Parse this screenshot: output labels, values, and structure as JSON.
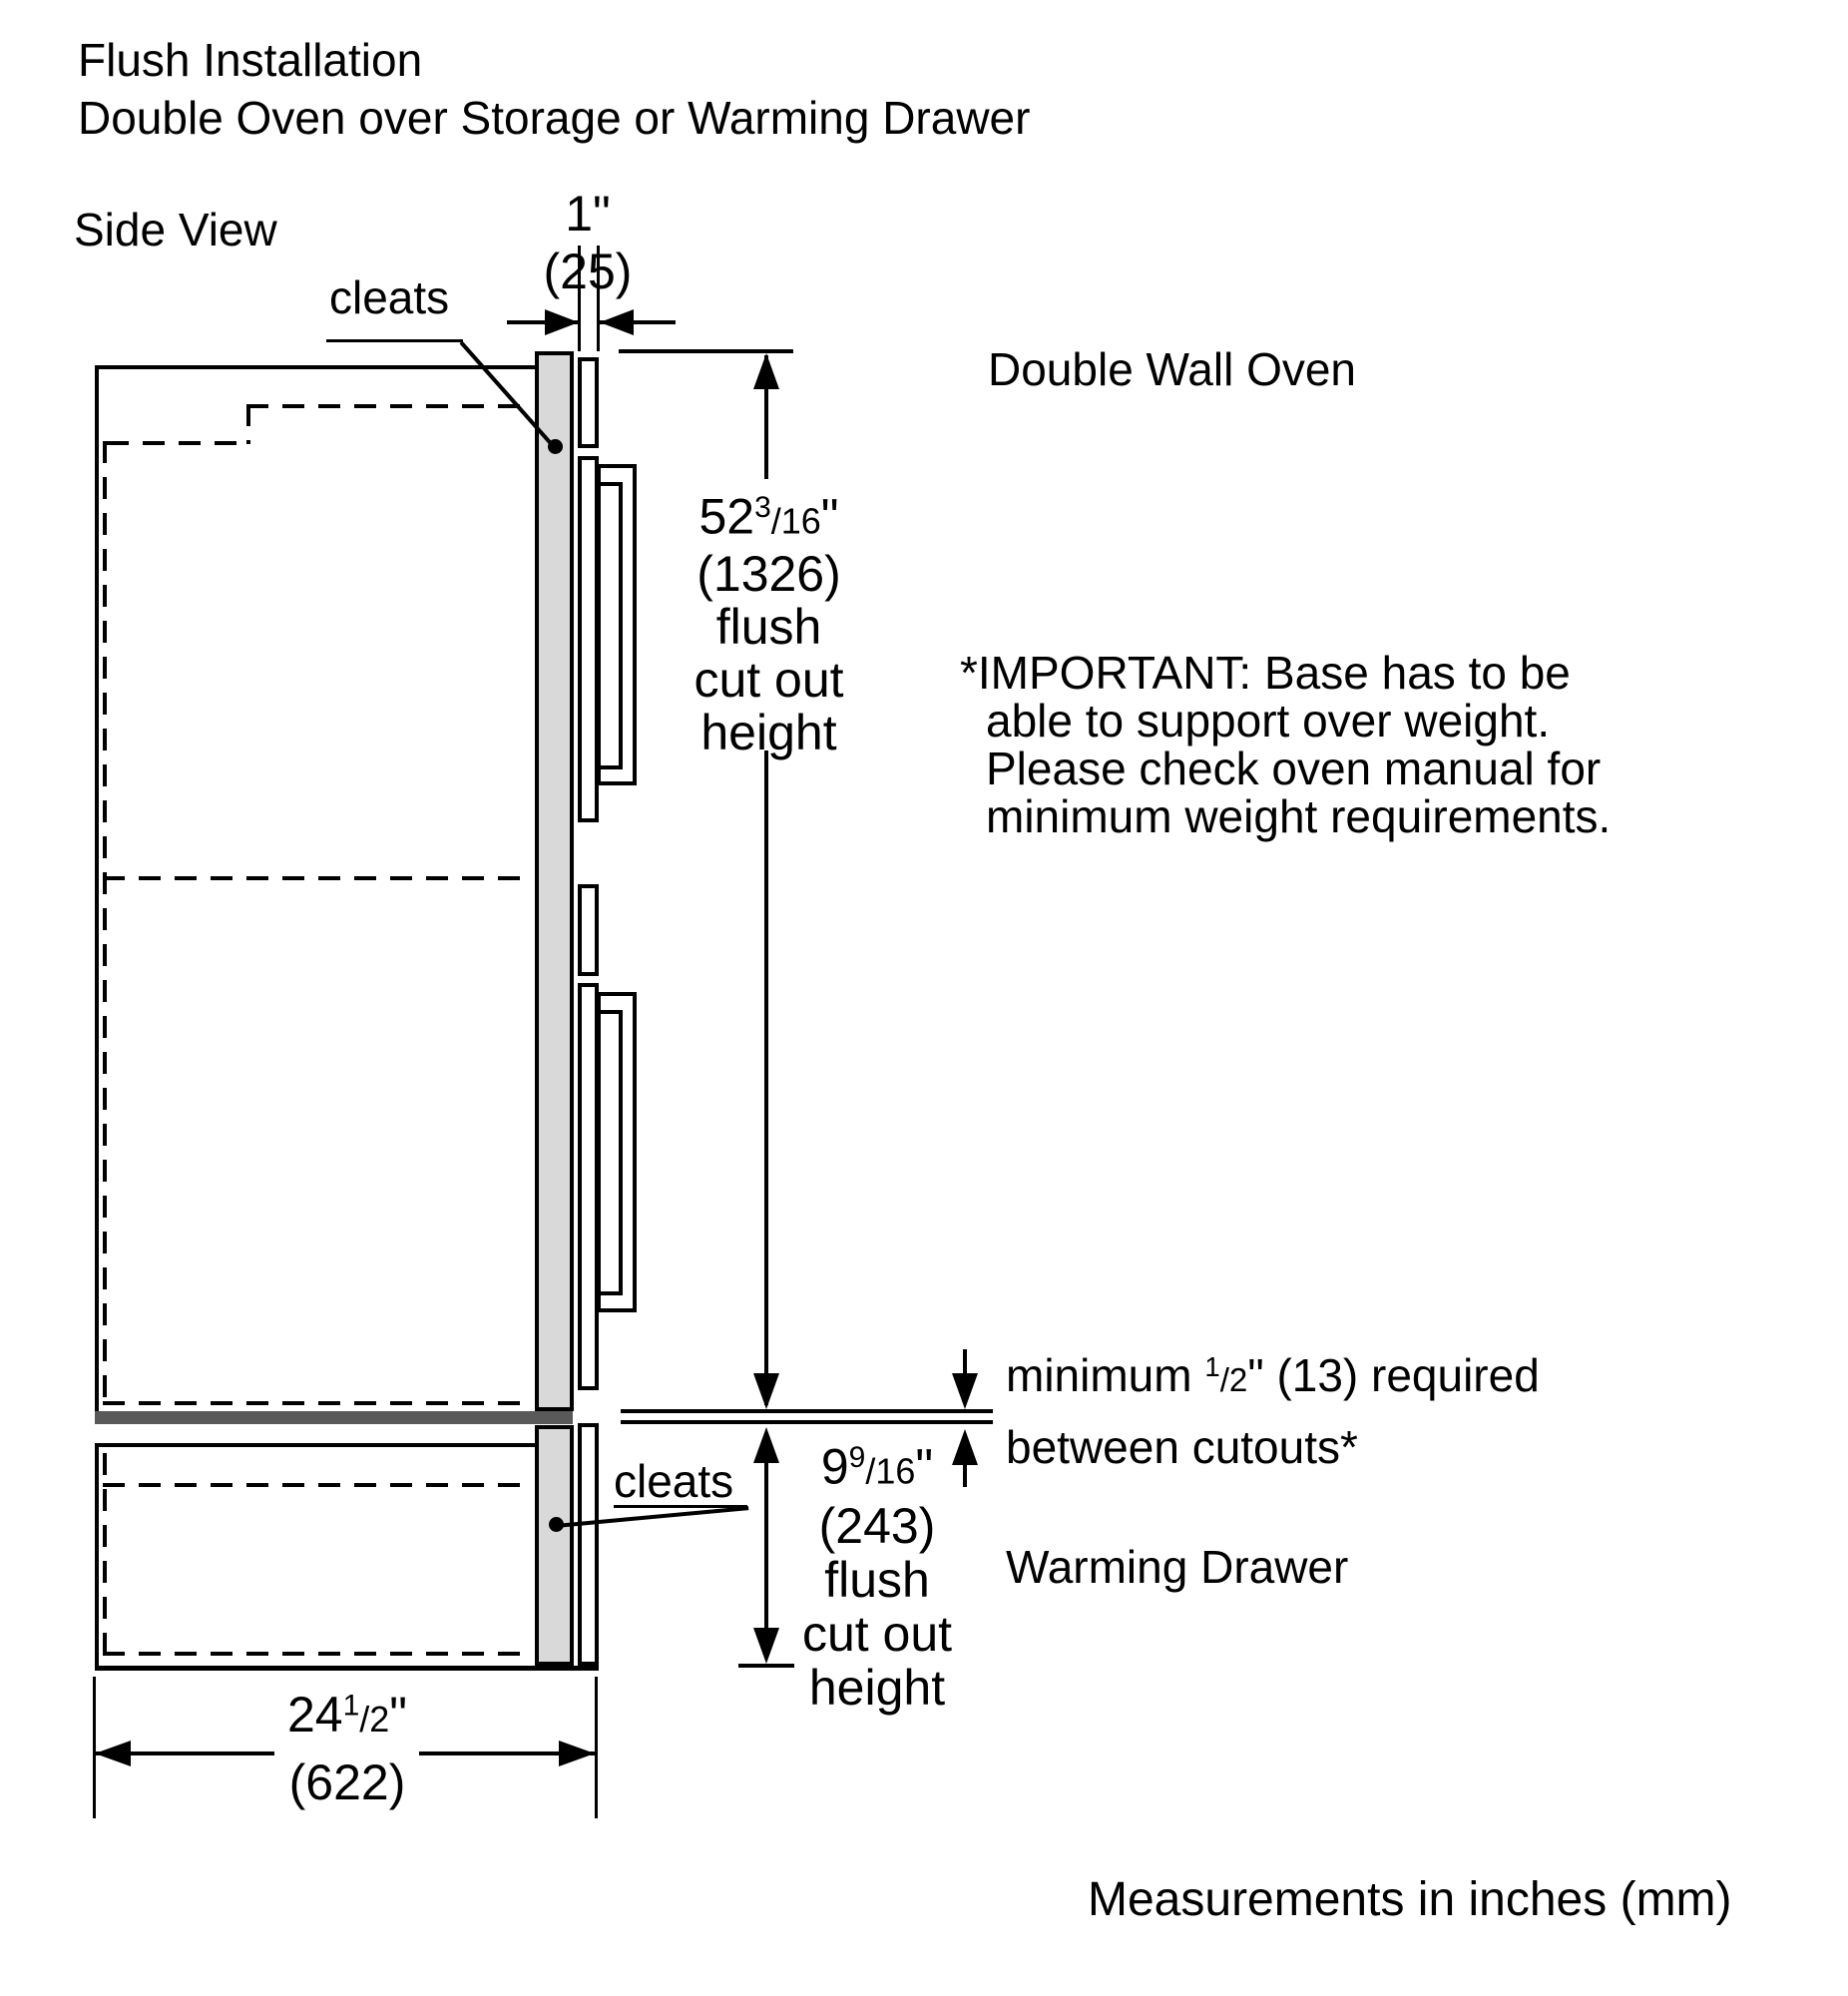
{
  "title": {
    "line1": "Flush Installation",
    "line2": "Double Oven over Storage or Warming Drawer"
  },
  "view_label": "Side View",
  "labels": {
    "cleats_top": "cleats",
    "cleats_bottom": "cleats",
    "double_wall_oven": "Double Wall Oven",
    "warming_drawer": "Warming Drawer",
    "measurements_note": "Measurements in inches (mm)"
  },
  "important_note": {
    "line1": "*IMPORTANT: Base has to be",
    "line2": "able to support over weight.",
    "line3": "Please check oven manual for",
    "line4": "minimum weight requirements."
  },
  "dimensions": {
    "cleat_thickness": {
      "inches": "1\"",
      "mm": "(25)"
    },
    "oven_cutout": {
      "whole": "52",
      "sup": "3",
      "frac": "/16",
      "unit": "\"",
      "mm": "(1326)",
      "desc1": "flush",
      "desc2": "cut out",
      "desc3": "height"
    },
    "drawer_cutout": {
      "whole": "9",
      "sup": "9",
      "frac": "/16",
      "unit": "\"",
      "mm": "(243)",
      "desc1": "flush",
      "desc2": "cut out",
      "desc3": "height"
    },
    "depth": {
      "whole": "24",
      "sup": "1",
      "frac": "/2",
      "unit": "\"",
      "mm": "(622)"
    },
    "between_cutouts": {
      "pre": "minimum ",
      "sup": "1",
      "frac": "/2",
      "post": "\" (13) required",
      "line2": "between cutouts*"
    }
  },
  "colors": {
    "cleat_fill": "#d9d9d9",
    "separator_fill": "#595959",
    "line": "#000000"
  }
}
